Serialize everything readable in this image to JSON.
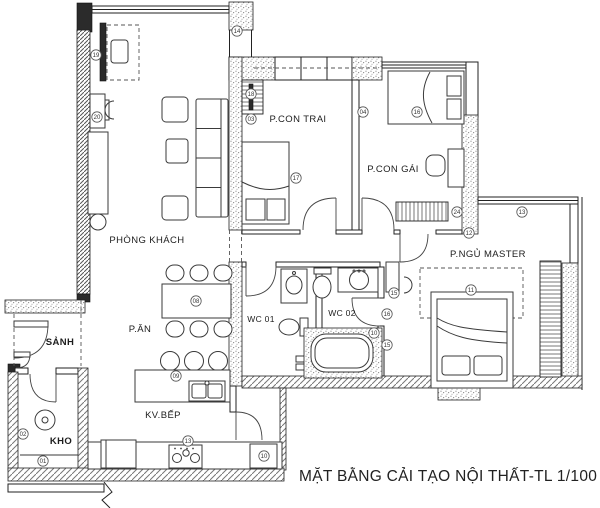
{
  "title": "MẶT BẰNG CẢI TẠO NỘI THẤT-TL 1/100",
  "rooms": {
    "living": "PHÒNG KHÁCH",
    "dining": "P.ĂN",
    "kitchen": "KV.BẾP",
    "hall": "SẢNH",
    "storage": "KHO",
    "wc1": "WC 01",
    "wc2": "WC 02",
    "boy_bedroom": "P.CON TRAI",
    "girl_bedroom": "P.CON GÁI",
    "master_bedroom": "P.NGỦ MASTER"
  },
  "markers": [
    "19",
    "20",
    "14",
    "18",
    "03",
    "17",
    "04",
    "16",
    "24",
    "12",
    "13",
    "11",
    "15",
    "16",
    "10",
    "15",
    "08",
    "09",
    "13",
    "10",
    "02",
    "01"
  ],
  "colors": {
    "wall_line": "#222222",
    "hatch": "#777777",
    "background": "#ffffff"
  }
}
